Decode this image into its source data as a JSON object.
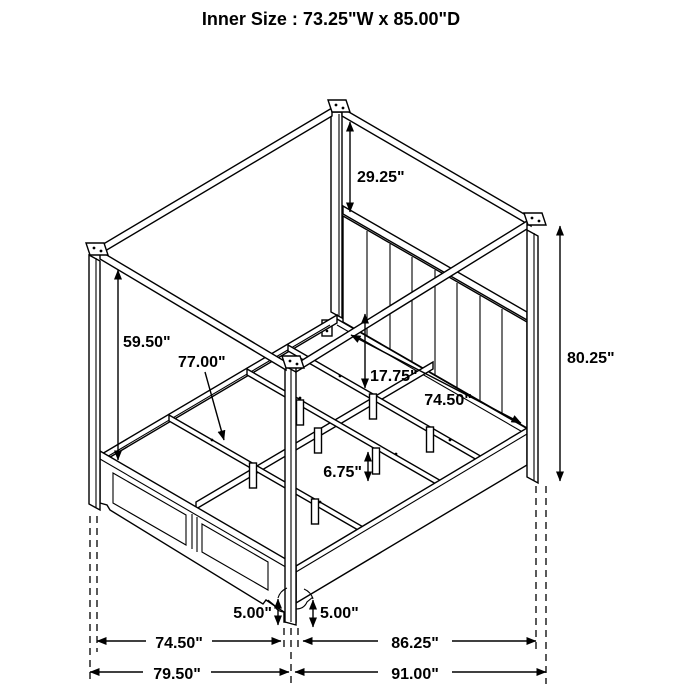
{
  "title": "Inner Size : 73.25\"W x 85.00\"D",
  "dimensions": {
    "headboard_to_canopy": "29.25\"",
    "left_post_exposed": "59.50\"",
    "slat_length": "77.00\"",
    "platform_height": "17.75\"",
    "headboard_inner_width": "74.50\"",
    "overall_height": "80.25\"",
    "support_leg_height": "6.75\"",
    "foot_bracket_left": "5.00\"",
    "foot_bracket_right": "5.00\"",
    "footboard_span": "74.50\"",
    "siderail_span": "86.25\"",
    "overall_width": "79.50\"",
    "overall_depth": "91.00\""
  },
  "colors": {
    "line": "#000000",
    "background": "#ffffff"
  }
}
